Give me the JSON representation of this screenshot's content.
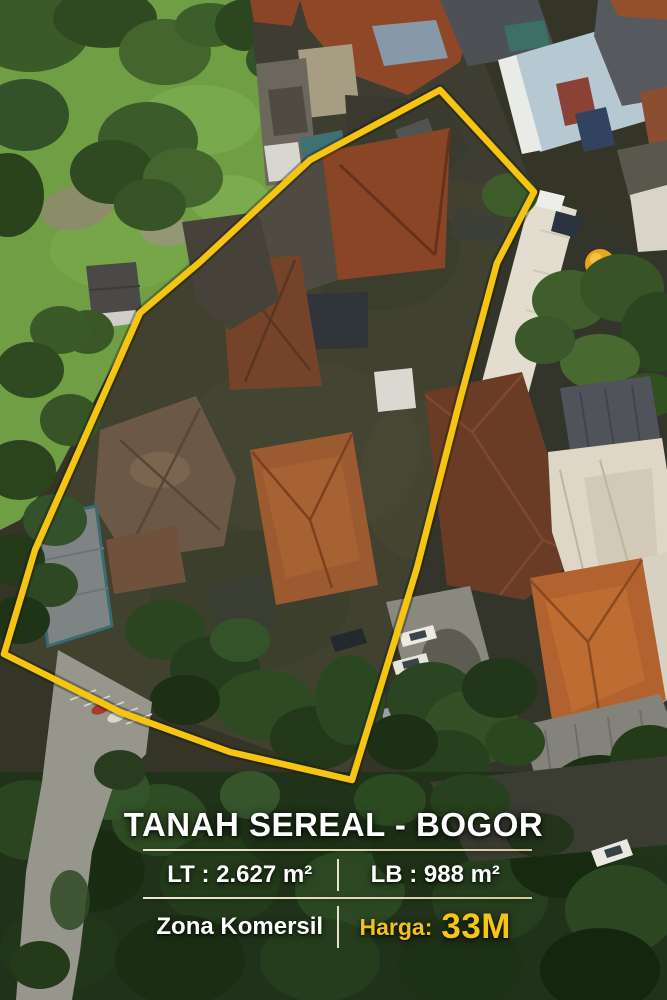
{
  "overlay": {
    "title": "TANAH SEREAL - BOGOR",
    "land_area": "LT : 2.627 m²",
    "building_area": "LB : 988 m²",
    "zone": "Zona Komersil",
    "price_label": "Harga:",
    "price_value": "33M"
  },
  "colors": {
    "boundary_yellow": "#f5c511",
    "price_label_yellow": "#f2bf1d",
    "price_value_yellow": "#f5c513",
    "text_white": "#ffffff"
  },
  "photo": {
    "description": "Aerial drone view of a land plot outlined with a yellow boundary, surrounded by tile-roof houses, trees and grass"
  }
}
